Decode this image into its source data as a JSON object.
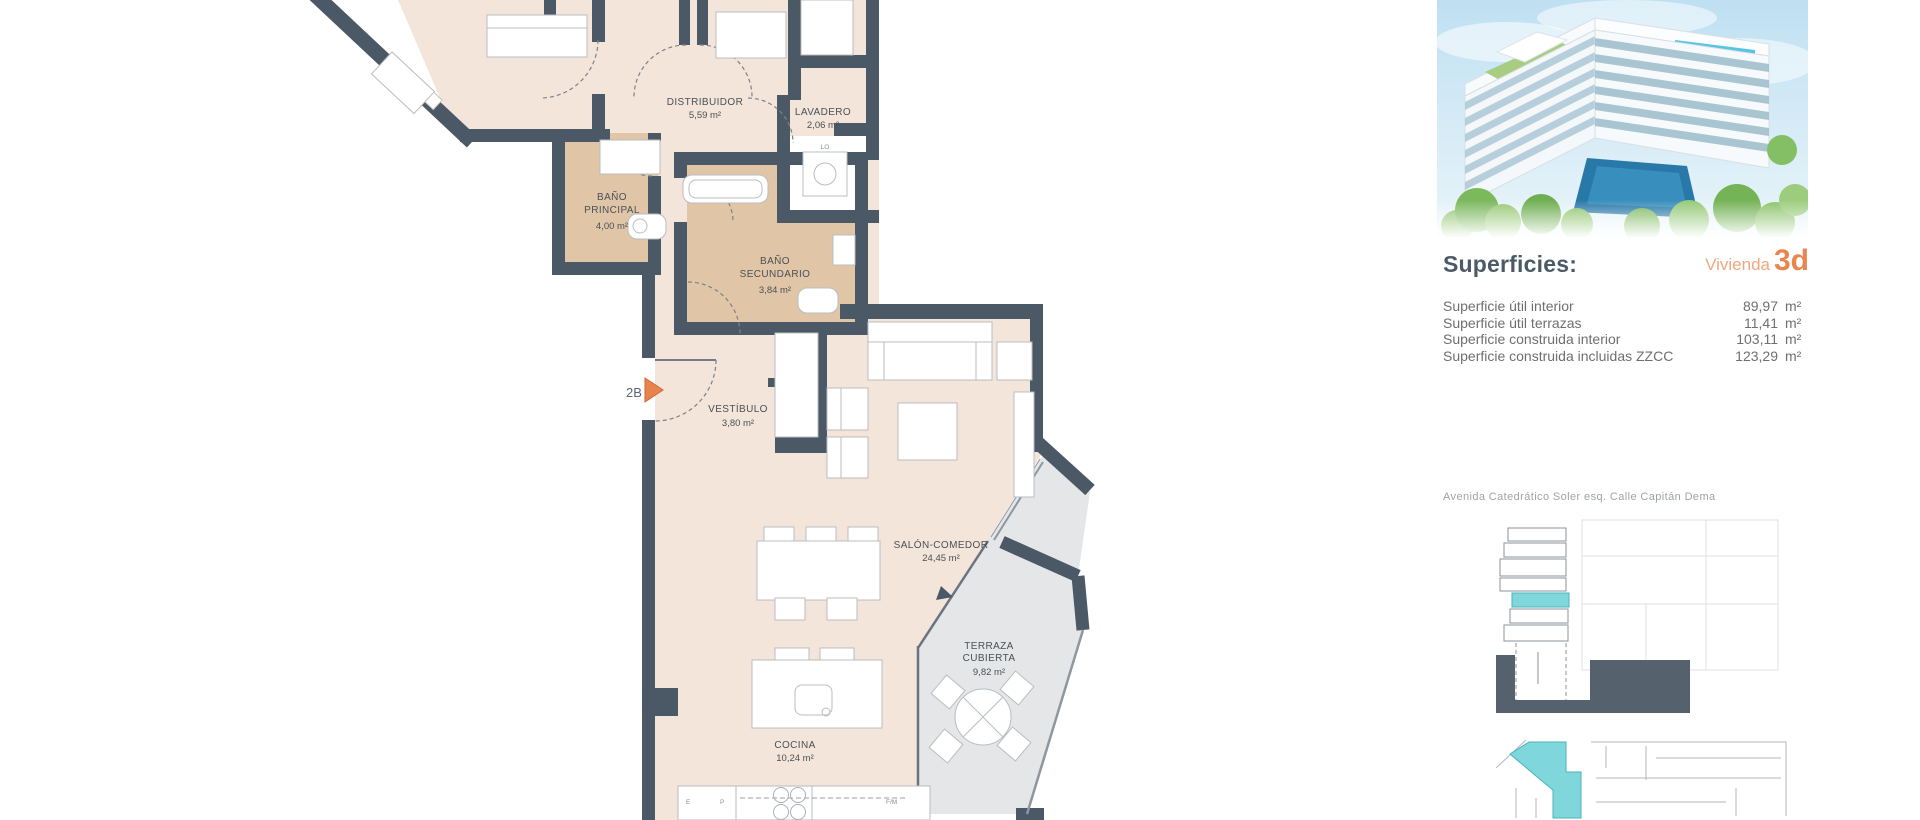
{
  "plan": {
    "unit_marker": "2B",
    "rooms": {
      "distribuidor": {
        "name": "DISTRIBUIDOR",
        "area": "5,59 m²"
      },
      "lavadero": {
        "name": "LAVADERO",
        "area": "2,06 m²"
      },
      "bano_principal": {
        "name1": "BAÑO",
        "name2": "PRINCIPAL",
        "area": "4,00 m²"
      },
      "bano_secundario": {
        "name1": "BAÑO",
        "name2": "SECUNDARIO",
        "area": "3,84 m²"
      },
      "vestibulo": {
        "name": "VESTÍBULO",
        "area": "3,80 m²"
      },
      "salon": {
        "name": "SALÓN-COMEDOR",
        "area": "24,45 m²"
      },
      "terraza": {
        "name1": "TERRAZA",
        "name2": "CUBIERTA",
        "area": "9,82 m²"
      },
      "cocina": {
        "name": "COCINA",
        "area": "10,24 m²"
      }
    },
    "fixture_codes": {
      "lavadero_unit": "LO",
      "kitchen_left": "E",
      "kitchen_mid": "P",
      "kitchen_right": "F/M"
    }
  },
  "panel": {
    "superficies_title": "Superficies:",
    "unit_label": "Vivienda",
    "unit_number": "3d",
    "rows": [
      {
        "label": "Superficie útil interior",
        "value": "89,97",
        "unit": "m²"
      },
      {
        "label": "Superficie útil terrazas",
        "value": "11,41",
        "unit": "m²"
      },
      {
        "label": "Superficie construida interior",
        "value": "103,11",
        "unit": "m²"
      },
      {
        "label": "Superficie construida incluidas ZZCC",
        "value": "123,29",
        "unit": "m²"
      }
    ],
    "address": "Avenida Catedrático Soler esq. Calle Capitán Dema"
  },
  "colors": {
    "wall": "#4b5866",
    "floor_beige": "#f3e5da",
    "floor_bath": "#e0c6a7",
    "terrace_grey": "#e4e6e7",
    "accent_orange": "#e8834d",
    "accent_orange_light": "#f0a87e",
    "highlight_cyan": "#7fd7db",
    "heading_slate": "#4b5a68"
  }
}
